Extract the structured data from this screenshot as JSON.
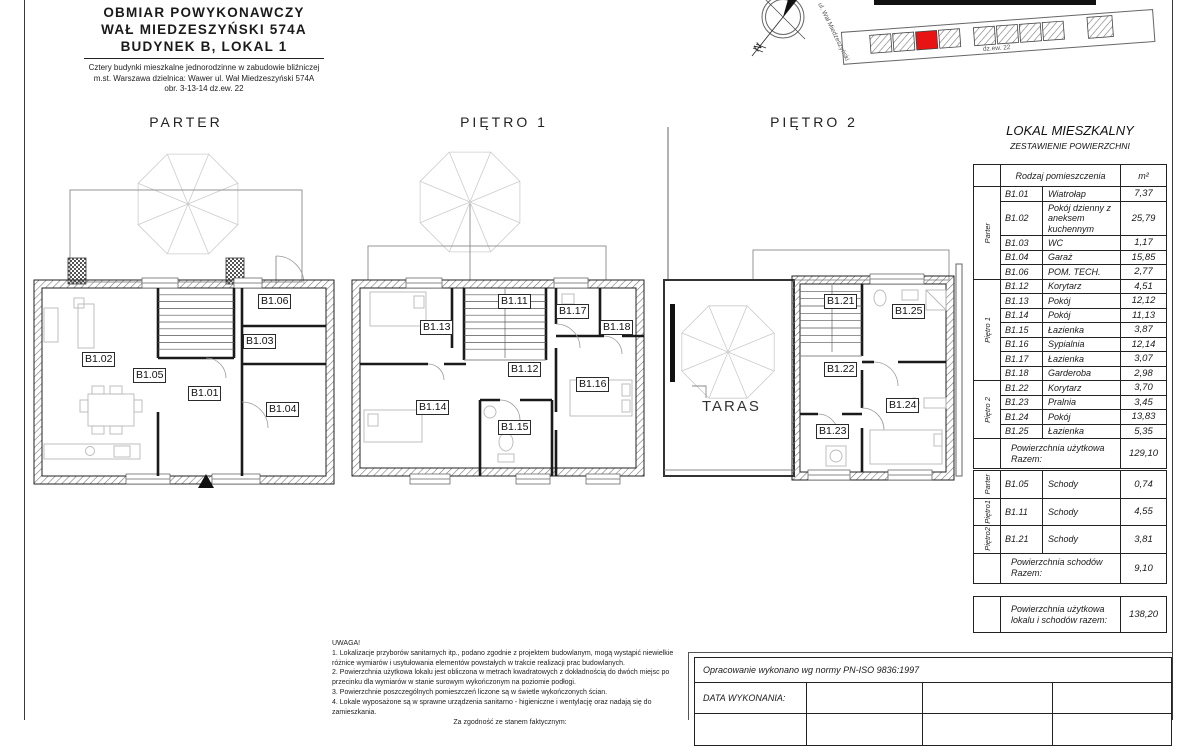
{
  "header": {
    "title1": "OBMIAR POWYKONAWCZY",
    "title2": "WAŁ MIEDZESZYŃSKI 574A",
    "title3": "BUDYNEK B, LOKAL 1",
    "sub1": "Cztery budynki mieszkalne jednorodzinne w zabudowie bliźniczej",
    "sub2": "m.st. Warszawa dzielnica: Wawer ul. Wał Miedzeszyński 574A",
    "sub3": "obr. 3-13-14 dz.ew. 22"
  },
  "site_plan": {
    "street_label": "ul. Wał Miedzeszyński",
    "plot_label": "dz.ew. 22",
    "north_label": "N",
    "highlight_color": "#e81313"
  },
  "plans": {
    "parter": {
      "title": "PARTER",
      "rooms": {
        "b101": "B1.01",
        "b102": "B1.02",
        "b103": "B1.03",
        "b104": "B1.04",
        "b105": "B1.05",
        "b106": "B1.06"
      }
    },
    "pietro1": {
      "title": "PIĘTRO 1",
      "rooms": {
        "b111": "B1.11",
        "b112": "B1.12",
        "b113": "B1.13",
        "b114": "B1.14",
        "b115": "B1.15",
        "b116": "B1.16",
        "b117": "B1.17",
        "b118": "B1.18"
      }
    },
    "pietro2": {
      "title": "PIĘTRO 2",
      "terrace_label": "TARAS",
      "rooms": {
        "b121": "B1.21",
        "b122": "B1.22",
        "b123": "B1.23",
        "b124": "B1.24",
        "b125": "B1.25"
      }
    }
  },
  "area_table": {
    "title": "LOKAL MIESZKALNY",
    "subtitle": "ZESTAWIENIE POWIERZCHNI",
    "header": {
      "type": "Rodzaj pomieszczenia",
      "area": "m²"
    },
    "groups": [
      {
        "label": "Parter",
        "rows": [
          {
            "code": "B1.01",
            "name": "Wiatrołap",
            "area": "7,37"
          },
          {
            "code": "B1.02",
            "name": "Pokój dzienny z aneksem kuchennym",
            "area": "25,79"
          },
          {
            "code": "B1.03",
            "name": "WC",
            "area": "1,17"
          },
          {
            "code": "B1.04",
            "name": "Garaż",
            "area": "15,85"
          },
          {
            "code": "B1.06",
            "name": "POM. TECH.",
            "area": "2,77"
          }
        ]
      },
      {
        "label": "Piętro 1",
        "rows": [
          {
            "code": "B1.12",
            "name": "Korytarz",
            "area": "4,51"
          },
          {
            "code": "B1.13",
            "name": "Pokój",
            "area": "12,12"
          },
          {
            "code": "B1.14",
            "name": "Pokój",
            "area": "11,13"
          },
          {
            "code": "B1.15",
            "name": "Łazienka",
            "area": "3,87"
          },
          {
            "code": "B1.16",
            "name": "Sypialnia",
            "area": "12,14"
          },
          {
            "code": "B1.17",
            "name": "Łazienka",
            "area": "3,07"
          },
          {
            "code": "B1.18",
            "name": "Garderoba",
            "area": "2,98"
          }
        ]
      },
      {
        "label": "Piętro 2",
        "rows": [
          {
            "code": "B1.22",
            "name": "Korytarz",
            "area": "3,70"
          },
          {
            "code": "B1.23",
            "name": "Pralnia",
            "area": "3,45"
          },
          {
            "code": "B1.24",
            "name": "Pokój",
            "area": "13,83"
          },
          {
            "code": "B1.25",
            "name": "Łazienka",
            "area": "5,35"
          }
        ]
      }
    ],
    "total_label": "Powierzchnia użytkowa Razem:",
    "total_value": "129,10"
  },
  "stairs_table": {
    "groups": [
      {
        "label": "Parter",
        "rows": [
          {
            "code": "B1.05",
            "name": "Schody",
            "area": "0,74"
          }
        ]
      },
      {
        "label": "Piętro1",
        "rows": [
          {
            "code": "B1.11",
            "name": "Schody",
            "area": "4,55"
          }
        ]
      },
      {
        "label": "Piętro2",
        "rows": [
          {
            "code": "B1.21",
            "name": "Schody",
            "area": "3,81"
          }
        ]
      }
    ],
    "total_label": "Powierzchnia schodów Razem:",
    "total_value": "9,10"
  },
  "grand_total": {
    "label": "Powierzchnia użytkowa lokalu i schodów razem:",
    "value": "138,20"
  },
  "notes": {
    "heading": "UWAGA!",
    "items": [
      "1. Lokalizacje przyborów sanitarnych itp., podano zgodnie z projektem budowlanym, mogą wystąpić niewielkie różnice wymiarów i usytułowania elementów powstałych w trakcie realizacji prac budowlanych.",
      "2. Powierzchnia użytkowa lokalu jest obliczona w metrach kwadratowych z dokładnością do dwóch miejsc po przecinku dla wymiarów w stanie surowym wykończonym na poziomie podłogi.",
      "3. Powierzchnie poszczególnych pomieszczeń liczone są w świetle wykończonych ścian.",
      "4. Lokale wyposażone są w sprawne urządzenia sanitarno - higieniczne i wentylację oraz nadają się do zamieszkania."
    ],
    "footer": "Za zgodność ze stanem faktycznym:"
  },
  "title_block": {
    "norm": "Opracowanie wykonano wg normy PN-ISO 9836:1997",
    "date_label": "DATA WYKONANIA:"
  }
}
